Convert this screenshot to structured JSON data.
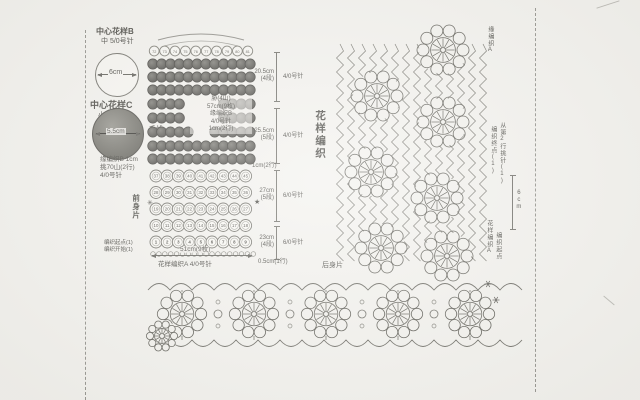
{
  "left_column": {
    "motif_b_title": "中心花样B",
    "motif_b_needle": "中 5/0号针",
    "motif_b_size": "6cm",
    "motif_c_title": "中心花样C",
    "motif_c_needle": "小 4/0号针",
    "motif_c_size": "5.5cm",
    "motif_c_yarn": "毛线",
    "edge_notes": [
      "缘编织B 1cm",
      "挑70山(2行)",
      "4/0号针"
    ]
  },
  "garment": {
    "piece_label": "前身片",
    "top_row_numbers": [
      "72",
      "73",
      "74",
      "75",
      "76",
      "77",
      "78",
      "79",
      "80",
      "81"
    ],
    "body_rows": [
      [
        "37",
        "38",
        "39",
        "40",
        "41",
        "42",
        "43",
        "44",
        "45"
      ],
      [
        "28",
        "29",
        "30",
        "31",
        "32",
        "33",
        "34",
        "35",
        "36"
      ],
      [
        "19",
        "20",
        "21",
        "22",
        "23",
        "24",
        "25",
        "26",
        "27"
      ],
      [
        "10",
        "11",
        "12",
        "13",
        "14",
        "15",
        "16",
        "17",
        "18"
      ],
      [
        "1",
        "2",
        "3",
        "4",
        "5",
        "6",
        "7",
        "8",
        "9"
      ]
    ],
    "mid_notes": [
      "胁(4山)",
      "57cm(9枚)",
      "缘编织B",
      "4/0号针",
      "1cm(2行)"
    ],
    "right_dims": [
      {
        "size": "20.5cm",
        "rows": "(4段)",
        "needle": "4/0号针"
      },
      {
        "size": "25.5cm",
        "rows": "(5段)",
        "needle": "4/0号针"
      },
      {
        "size": "27cm",
        "rows": "(5段)",
        "needle": "6/0号针"
      },
      {
        "size": "23cm",
        "rows": "(4段)",
        "needle": "6/0号针"
      }
    ],
    "waist_note": "1cm(2行)",
    "hem_note": "0.5cm(1行)",
    "bottom_width": "51cm(9枚)",
    "start_notes": [
      "编织起点(1)",
      "编织开始(1)"
    ],
    "bottom_pattern": "花样编织A 4/0号针",
    "markers": {
      "left": "✳",
      "right": "★"
    }
  },
  "right_panel": {
    "title": "花样编织",
    "top_label": "缘编织A",
    "side_label_1": "编织终点(1)",
    "side_label_2": "从第2行挑针(1)",
    "height_label": "6cm",
    "bottom_label_1": "花样编织A",
    "bottom_label_2": "编织起点"
  },
  "bottom_panel": {
    "label": "后身片"
  }
}
